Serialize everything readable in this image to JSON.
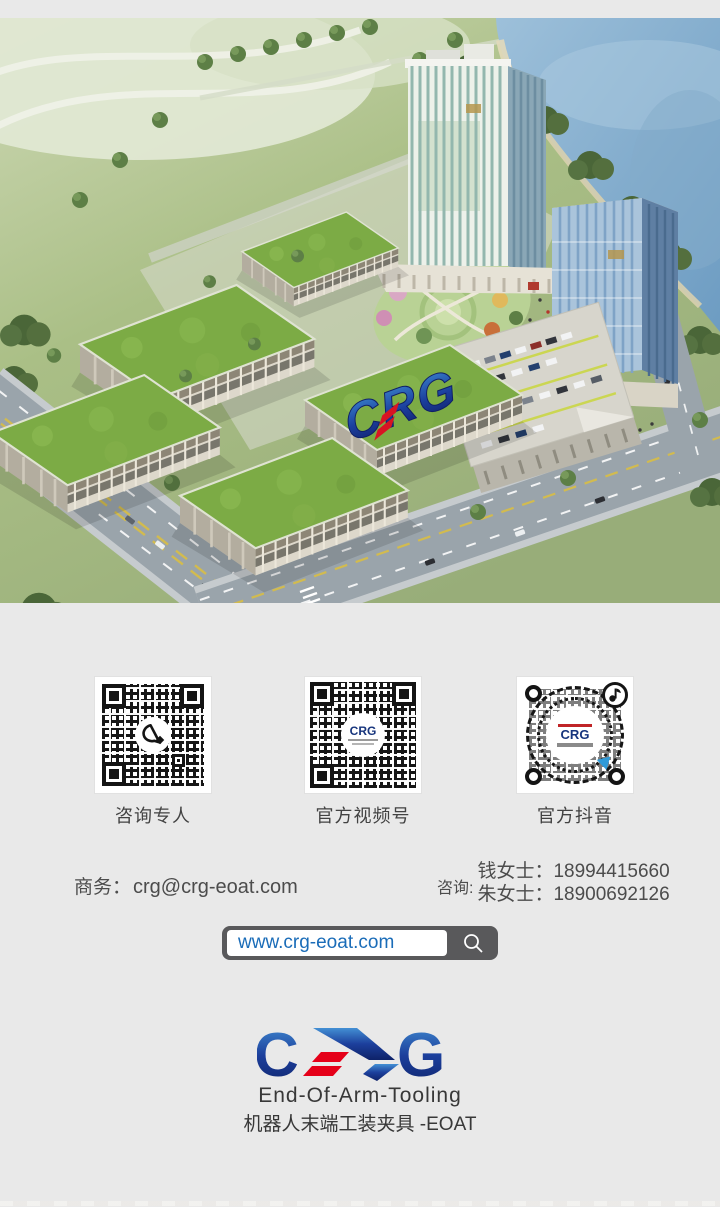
{
  "page": {
    "background": "#e9e9e9"
  },
  "hero": {
    "description": "Aerial rendering of CRG industrial campus: green-roof factory buildings, two glass towers, rooftop parking deck, lakeside park",
    "roof_logo_text": "CRG"
  },
  "qr_section": {
    "items": [
      {
        "label": "咨询专人",
        "icon": "wechat-chat-bubble"
      },
      {
        "label": "官方视频号",
        "center_logo": "CRG"
      },
      {
        "label": "官方抖音",
        "center_logo": "CRG",
        "icon": "tiktok-note"
      }
    ]
  },
  "contact": {
    "business_label": "商务：",
    "business_email": "crg@crg-eoat.com",
    "consult_label": "咨询:",
    "consult_lines": [
      "钱女士：18994415660",
      "朱女士：18900692126"
    ]
  },
  "search_bar": {
    "url": "www.crg-eoat.com",
    "icon": "magnifier"
  },
  "footer_logo": {
    "wordmark": "CRG",
    "letter_c": "C",
    "letter_g": "G",
    "tagline_en": "End-Of-Arm-Tooling",
    "tagline_cn": "机器人末端工装夹具 -EOAT"
  },
  "colors": {
    "accent_blue": "#1a6cb8",
    "logo_navy": "#16357e",
    "logo_red": "#e50019",
    "bar_dark": "#59595b",
    "text_dark": "#4a4a4a",
    "roof_green": "#7cab45"
  }
}
